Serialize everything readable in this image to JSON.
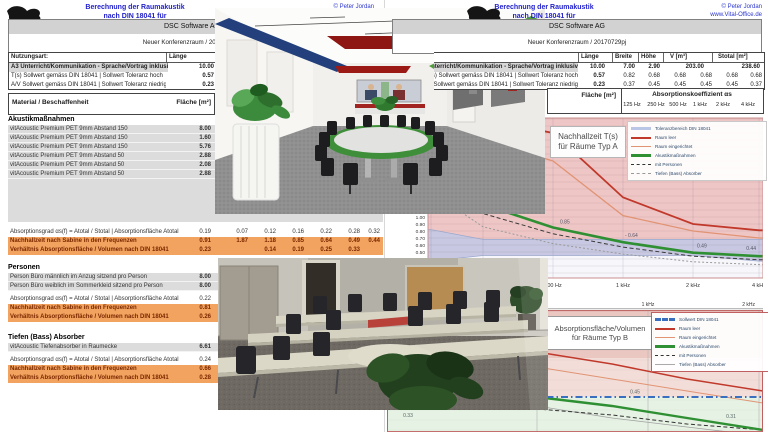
{
  "brand": {
    "logo_text": "Vital-Office®",
    "title_line1": "Berechnung der Raumakustik",
    "title_line2": "nach DIN 18041 für",
    "copyright": "© Peter Jordan",
    "website": "www.Vital-Office.de"
  },
  "company": "DSC Software AG",
  "left_page": {
    "room_ref": "Neuer Konferenzraum / 20170729ni"
  },
  "right_page": {
    "room_ref": "Neuer Konferenzraum / 20170729pj"
  },
  "usage_table": {
    "nutzungsart_label": "Nutzungsart:",
    "cols": [
      "Länge",
      "Breite",
      "Höhe",
      "V [m³]",
      "Stotal [m²]"
    ],
    "rows": [
      {
        "label": "A3 Unterricht/Kommunikation - Sprache/Vortrag inklusiv",
        "values": [
          "10.00",
          "7.00",
          "2.90",
          "203.00",
          "238.60"
        ]
      },
      {
        "label": "T(s) Sollwert gemäss DIN 18041 | Sollwert Toleranz hoch",
        "value": "0.57",
        "freq": [
          "0.82",
          "0.68",
          "0.68",
          "0.68",
          "0.68",
          "0.68"
        ]
      },
      {
        "label": "A/V Sollwert gemäss DIN 18041 | Sollwert Toleranz niedrig",
        "value": "0.23",
        "freq": [
          "0.37",
          "0.45",
          "0.45",
          "0.45",
          "0.45",
          "0.37"
        ]
      }
    ]
  },
  "material_header": {
    "material": "Material / Beschaffenheit",
    "flaeche": "Fläche [m²]",
    "absorption": "Absorptionskoeffizient αs",
    "freqs": [
      "125 Hz",
      "250 Hz",
      "500 Hz",
      "1 kHz",
      "2 kHz",
      "4 kHz"
    ]
  },
  "sections": [
    {
      "title": "Akustikmaßnahmen",
      "items": [
        {
          "name": "vitAcoustic Premium PET 9mm Abstand 150",
          "area": "8.00"
        },
        {
          "name": "vitAcoustic Premium PET 9mm Abstand 150",
          "area": "1.60"
        },
        {
          "name": "vitAcoustic Premium PET 9mm Abstand 150",
          "area": "5.76"
        },
        {
          "name": "vitAcoustic Premium PET 9mm Abstand 50",
          "area": "2.88"
        },
        {
          "name": "vitAcoustic Premium PET 9mm Abstand 50",
          "area": "2.08"
        },
        {
          "name": "vitAcoustic Premium PET 9mm Abstand 50",
          "area": "2.88"
        }
      ],
      "stats": [
        {
          "label": "Absorptionsgrad αs(f) = Atotal / Stotal | Absorptionsfläche Atotal",
          "value": "0.19",
          "freq": [
            "0.07",
            "0.12",
            "0.16",
            "0.22",
            "0.28",
            "0.32"
          ]
        },
        {
          "label": "Nachhallzeit nach Sabine in den Frequenzen",
          "value": "0.91",
          "freq": [
            "1.87",
            "1.18",
            "0.85",
            "0.64",
            "0.49",
            "0.44"
          ]
        },
        {
          "label": "Verhältnis Absorptionsfläche / Volumen nach DIN 18041",
          "value": "0.23",
          "freq": [
            "",
            "0.14",
            "0.19",
            "0.25",
            "0.33",
            ""
          ]
        }
      ]
    },
    {
      "title": "Personen",
      "items": [
        {
          "name": "Person Büro männlich im Anzug sitzend pro Person",
          "area": "8.00"
        },
        {
          "name": "Person Büro weiblich im Sommerkleid sitzend pro Person",
          "area": "8.00"
        }
      ],
      "stats": [
        {
          "label": "Absorptionsgrad αs(f) = Atotal / Stotal | Absorptionsfläche Atotal",
          "value": "0.22"
        },
        {
          "label": "Nachhallzeit nach Sabine in den Frequenzen",
          "value": "0.81"
        },
        {
          "label": "Verhältnis Absorptionsfläche / Volumen nach DIN 18041",
          "value": "0.26"
        }
      ]
    },
    {
      "title": "Tiefen (Bass) Absorber",
      "items": [
        {
          "name": "vitAcoustic Tiefenabsorber in Raumecke",
          "area": "6.61"
        }
      ],
      "stats": [
        {
          "label": "Absorptionsgrad αs(f) = Atotal / Stotal | Absorptionsfläche Atotal",
          "value": "0.24"
        },
        {
          "label": "Nachhallzeit nach Sabine in den Frequenzen",
          "value": "0.66"
        },
        {
          "label": "Verhältnis Absorptionsfläche / Volumen nach DIN 18041",
          "value": "0.28"
        }
      ]
    }
  ],
  "chart_data": [
    {
      "type": "line",
      "title": "Nachhallzeit T(s) für Räume Typ A",
      "title_l1": "Nachhallzeit T(s)",
      "title_l2": "für Räume Typ A",
      "x_labels": [
        "125 Hz",
        "250 Hz",
        "500 Hz",
        "1 kHz",
        "2 kHz",
        "4 kHz"
      ],
      "ylabel": "T [s]",
      "ylim": [
        0.1,
        2.4
      ],
      "grid": true,
      "legend_position": "top-right",
      "legend": [
        "Toleranzbereich DIN 18041",
        "Raum leer",
        "Raum eingerichtet",
        "Akustikmaßnahmen",
        "mit Personen",
        "Tiefen (Bass) Absorber"
      ],
      "tolerance_upper": [
        0.82,
        0.68,
        0.68,
        0.68,
        0.68,
        0.68
      ],
      "tolerance_lower": [
        0.37,
        0.45,
        0.45,
        0.45,
        0.45,
        0.37
      ],
      "series": [
        {
          "name": "Raum leer",
          "values": [
            2.45,
            2.4,
            2.2,
            1.28,
            0.9,
            0.81
          ]
        },
        {
          "name": "Raum eingerichtet",
          "values": [
            2.35,
            2.1,
            1.8,
            1.02,
            0.8,
            0.7
          ]
        },
        {
          "name": "Akustikmaßnahmen",
          "values": [
            1.87,
            1.18,
            0.85,
            0.64,
            0.49,
            0.44
          ]
        },
        {
          "name": "mit Personen",
          "values": [
            1.66,
            1.05,
            0.76,
            0.57,
            0.44,
            0.39
          ]
        },
        {
          "name": "Tiefen (Bass) Absorber",
          "values": [
            1.36,
            0.86,
            0.62,
            0.47,
            0.36,
            0.32
          ]
        }
      ],
      "point_labels": [
        "0.85",
        "- 0.64",
        "0.49",
        "0.44"
      ]
    },
    {
      "type": "line",
      "title": "Absorptionsfläche/Volumen für Räume Typ B",
      "title_l1": "Absorptionsfläche/Volumen",
      "title_l2": "für Räume Typ B",
      "x_labels": [
        "125 Hz",
        "250 Hz",
        "500 Hz",
        "1 kHz",
        "2 kHz",
        "4 kHz"
      ],
      "visible_x_labels": [
        "500 Hz",
        "1 kHz",
        "2 kHz"
      ],
      "ylabel": "A/V",
      "legend_position": "top-right",
      "legend": [
        "Sollwert DIN 18041",
        "Raum leer",
        "Raum eingerichtet",
        "Akustikmaßnahmen",
        "mit Personen",
        "Tiefen (Bass) Absorber"
      ],
      "series": [
        {
          "name": "Sollwert DIN 18041",
          "values": [
            0.45,
            0.45,
            0.45,
            0.45,
            0.45,
            0.45
          ]
        },
        {
          "name": "Raum leer",
          "values": [
            0.68,
            0.64,
            0.6,
            0.56,
            0.51,
            0.47
          ]
        },
        {
          "name": "Raum eingerichtet",
          "values": [
            0.63,
            0.59,
            0.55,
            0.51,
            0.47,
            0.43
          ]
        },
        {
          "name": "Akustikmaßnahmen",
          "values": [
            0.53,
            0.49,
            0.45,
            0.42,
            0.38,
            0.34
          ]
        },
        {
          "name": "mit Personen",
          "values": [
            0.46,
            0.44,
            0.41,
            0.39,
            0.36,
            0.34
          ]
        },
        {
          "name": "Tiefen (Bass) Absorber",
          "values": [
            0.49,
            0.45,
            0.42,
            0.38,
            0.35,
            0.32
          ]
        }
      ],
      "point_labels": [
        "0.33",
        "0.45",
        "0.31"
      ]
    }
  ]
}
